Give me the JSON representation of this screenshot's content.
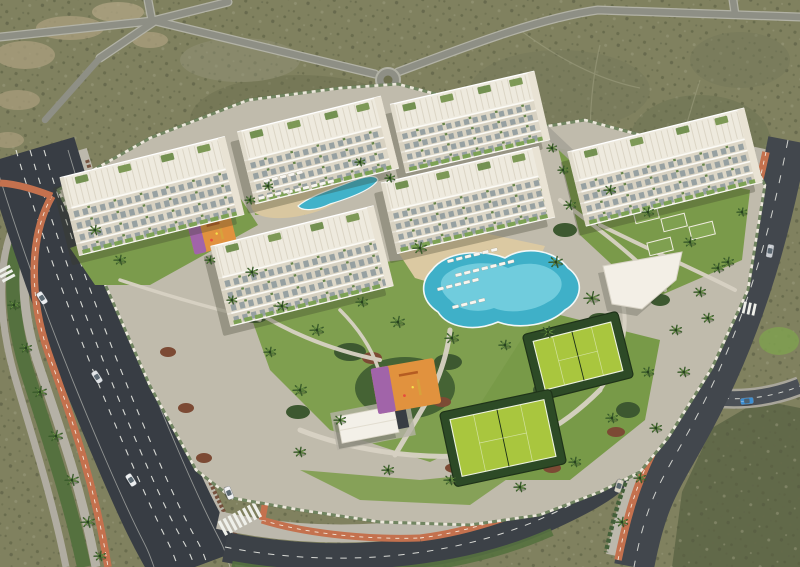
{
  "scene": {
    "type": "aerial-architectural-render",
    "description": "Aerial 3D render of a white low-rise residential apartment complex in desert scrubland, surrounded by avenues with terracotta bike lanes, palm trees, lagoon pools, paddle courts, playgrounds and cars."
  },
  "palette": {
    "desert": "#80815f",
    "desert_dark": "#5e6748",
    "sand": "#ab9f7e",
    "asphalt": "#383d44",
    "asphalt_light": "#42474d",
    "road_minor": "#8e8f85",
    "sidewalk": "#bcb8ac",
    "bike_lane": "#c4714e",
    "lane_dash": "#e9eae4",
    "parcel": "#c0bbac",
    "lawn": "#7f9f4f",
    "hedge": "#44603a",
    "hedge_red": "#6f4733",
    "pool_deep": "#3fb0c8",
    "pool_light": "#8adbe8",
    "deck_tan": "#dbc9a2",
    "building_white": "#f5f2ea",
    "roof_white": "#eeeade",
    "glass": "#8b989b",
    "court_green": "#a9c63e",
    "court_surround": "#2d4a26",
    "play_orange": "#e1923e",
    "play_purple": "#9a5fb5",
    "car_blue": "#3e8fd2"
  },
  "buildings": [
    {
      "cx": 152,
      "cy": 196,
      "len": 170,
      "dep": 80,
      "a": -14
    },
    {
      "cx": 318,
      "cy": 150,
      "len": 148,
      "dep": 74,
      "a": -14
    },
    {
      "cx": 470,
      "cy": 122,
      "len": 148,
      "dep": 70,
      "a": -13
    },
    {
      "cx": 468,
      "cy": 200,
      "len": 162,
      "dep": 72,
      "a": -13
    },
    {
      "cx": 302,
      "cy": 266,
      "len": 168,
      "dep": 82,
      "a": -14
    },
    {
      "cx": 665,
      "cy": 167,
      "len": 182,
      "dep": 76,
      "a": -14
    }
  ],
  "courts": [
    {
      "cx": 578,
      "cy": 356,
      "w": 80,
      "h": 50,
      "a": -14
    },
    {
      "cx": 503,
      "cy": 438,
      "w": 96,
      "h": 58,
      "a": -12
    }
  ],
  "playgrounds": [
    {
      "cx": 212,
      "cy": 233,
      "w": 44,
      "h": 34,
      "a": -14
    },
    {
      "cx": 406,
      "cy": 386,
      "w": 64,
      "h": 46,
      "a": -10
    }
  ],
  "lounger_rows": [
    {
      "x": 447,
      "y": 260,
      "n": 6,
      "gap": 9,
      "a": -14
    },
    {
      "x": 455,
      "y": 274,
      "n": 7,
      "gap": 9,
      "a": -14
    },
    {
      "x": 437,
      "y": 288,
      "n": 5,
      "gap": 9,
      "a": -14
    },
    {
      "x": 263,
      "y": 180,
      "n": 5,
      "gap": 8.5,
      "a": -14
    },
    {
      "x": 286,
      "y": 191,
      "n": 6,
      "gap": 8.5,
      "a": -14
    },
    {
      "x": 258,
      "y": 197,
      "n": 4,
      "gap": 8.5,
      "a": -14
    },
    {
      "x": 452,
      "y": 306,
      "n": 4,
      "gap": 9,
      "a": -14
    }
  ],
  "cars": [
    {
      "x": 42,
      "y": 298,
      "a": 57,
      "c": "#eceef0"
    },
    {
      "x": 97,
      "y": 377,
      "a": 57,
      "c": "#dfe2e5"
    },
    {
      "x": 131,
      "y": 480,
      "a": 58,
      "c": "#eceef0"
    },
    {
      "x": 229,
      "y": 493,
      "a": 68,
      "c": "#f1f1f3"
    },
    {
      "x": 770,
      "y": 251,
      "a": 100,
      "c": "#c9ccd1"
    },
    {
      "x": 619,
      "y": 486,
      "a": 108,
      "c": "#d9d3c4"
    },
    {
      "x": 747,
      "y": 401,
      "a": -6,
      "c": "#3e8fd2"
    }
  ],
  "palms": [
    {
      "x": 420,
      "y": 248,
      "s": 7
    },
    {
      "x": 556,
      "y": 262,
      "s": 7
    },
    {
      "x": 592,
      "y": 298,
      "s": 8
    },
    {
      "x": 548,
      "y": 332,
      "s": 7
    },
    {
      "x": 505,
      "y": 345,
      "s": 6
    },
    {
      "x": 452,
      "y": 338,
      "s": 7
    },
    {
      "x": 398,
      "y": 322,
      "s": 7
    },
    {
      "x": 362,
      "y": 302,
      "s": 6
    },
    {
      "x": 317,
      "y": 330,
      "s": 7
    },
    {
      "x": 282,
      "y": 306,
      "s": 6
    },
    {
      "x": 252,
      "y": 272,
      "s": 6
    },
    {
      "x": 232,
      "y": 300,
      "s": 5
    },
    {
      "x": 270,
      "y": 352,
      "s": 6
    },
    {
      "x": 300,
      "y": 390,
      "s": 7
    },
    {
      "x": 340,
      "y": 420,
      "s": 6
    },
    {
      "x": 300,
      "y": 452,
      "s": 6
    },
    {
      "x": 388,
      "y": 470,
      "s": 6
    },
    {
      "x": 450,
      "y": 480,
      "s": 6
    },
    {
      "x": 520,
      "y": 487,
      "s": 6
    },
    {
      "x": 575,
      "y": 462,
      "s": 6
    },
    {
      "x": 612,
      "y": 418,
      "s": 6
    },
    {
      "x": 648,
      "y": 372,
      "s": 6
    },
    {
      "x": 676,
      "y": 330,
      "s": 6
    },
    {
      "x": 700,
      "y": 292,
      "s": 6
    },
    {
      "x": 570,
      "y": 205,
      "s": 6
    },
    {
      "x": 610,
      "y": 190,
      "s": 6
    },
    {
      "x": 648,
      "y": 212,
      "s": 6
    },
    {
      "x": 690,
      "y": 242,
      "s": 6
    },
    {
      "x": 718,
      "y": 268,
      "s": 6
    },
    {
      "x": 552,
      "y": 148,
      "s": 5
    },
    {
      "x": 563,
      "y": 170,
      "s": 5
    },
    {
      "x": 268,
      "y": 186,
      "s": 5
    },
    {
      "x": 360,
      "y": 162,
      "s": 5
    },
    {
      "x": 390,
      "y": 178,
      "s": 5
    },
    {
      "x": 95,
      "y": 230,
      "s": 6
    },
    {
      "x": 120,
      "y": 260,
      "s": 6
    },
    {
      "x": 250,
      "y": 200,
      "s": 5
    },
    {
      "x": 210,
      "y": 260,
      "s": 5
    },
    {
      "x": 14,
      "y": 305,
      "s": 6
    },
    {
      "x": 26,
      "y": 348,
      "s": 6
    },
    {
      "x": 40,
      "y": 392,
      "s": 7
    },
    {
      "x": 56,
      "y": 436,
      "s": 7
    },
    {
      "x": 72,
      "y": 480,
      "s": 7
    },
    {
      "x": 88,
      "y": 522,
      "s": 7
    },
    {
      "x": 100,
      "y": 556,
      "s": 6
    },
    {
      "x": 742,
      "y": 212,
      "s": 5
    },
    {
      "x": 728,
      "y": 262,
      "s": 6
    },
    {
      "x": 708,
      "y": 318,
      "s": 6
    },
    {
      "x": 684,
      "y": 372,
      "s": 6
    },
    {
      "x": 656,
      "y": 428,
      "s": 6
    },
    {
      "x": 640,
      "y": 478,
      "s": 6
    },
    {
      "x": 622,
      "y": 522,
      "s": 6
    }
  ]
}
